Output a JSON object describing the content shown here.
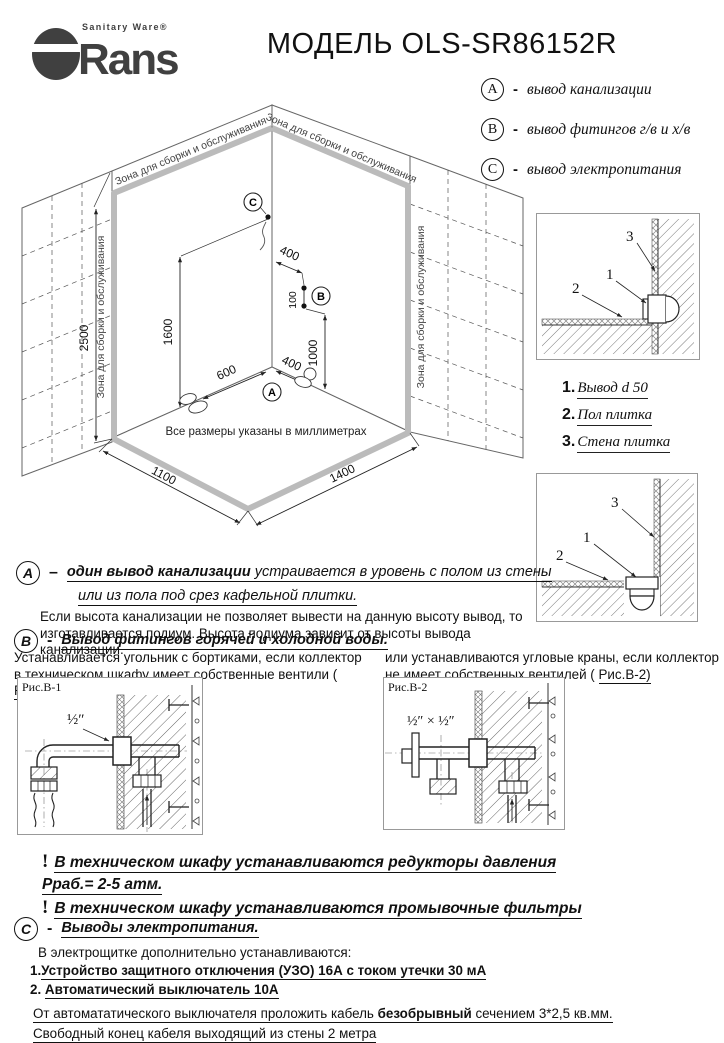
{
  "header": {
    "brand": "Rans",
    "tagline": "Sanitary Ware®",
    "title": "МОДЕЛЬ OLS-SR86152R"
  },
  "legend": {
    "items": [
      {
        "key": "A",
        "dash": "-",
        "label": "вывод канализации"
      },
      {
        "key": "B",
        "dash": "-",
        "label": "вывод фитингов г/в и х/в"
      },
      {
        "key": "C",
        "dash": "-",
        "label": "вывод электропитания"
      }
    ]
  },
  "iso": {
    "zone_text": "Зона для сборки и обслуживания",
    "note": "Все размеры указаны в миллиметрах",
    "dims": {
      "wall_height": "2500",
      "c_height": "1600",
      "b_offset": "400",
      "b_gap": "100",
      "b_height": "1000",
      "floor_left": "600",
      "floor_right": "400",
      "front_left": "1100",
      "front_right": "1400"
    },
    "points": {
      "a": "A",
      "b": "B",
      "c": "C"
    }
  },
  "details": {
    "callout_1": "1",
    "callout_2": "2",
    "callout_3": "3",
    "list": [
      {
        "num": "1.",
        "label": "Вывод d 50"
      },
      {
        "num": "2.",
        "label": "Пол плитка"
      },
      {
        "num": "3.",
        "label": "Стена плитка"
      }
    ]
  },
  "section_a": {
    "key": "A",
    "dash": "–",
    "head_bold": "один вывод канализации",
    "head_rest": " устраивается в уровень с полом из стены",
    "head_line2": "или из пола под срез кафельной плитки.",
    "body_line1": "Если высота канализации не позволяет вывести на данную высоту вывод, то",
    "body_line2": "изготавливается подиум. Высота подиума зависит от высоты вывода канализации."
  },
  "section_b": {
    "key": "B",
    "dash": "-",
    "head": "Вывод фитингов горячей и холодной воды.",
    "left_line1": "Устанавливается угольник с бортиками,  если коллектор",
    "left_line2": "в техническом шкафу имеет собственные вентили ( ",
    "left_ref": "Рис.В-1)",
    "right_line1": "или  устанавливаются угловые краны, если коллектор",
    "right_line2": "не имеет собственных вентилей ( ",
    "right_ref": "Рис.В-2)",
    "fig1": {
      "label": "Рис.В-1",
      "size": "½″"
    },
    "fig2": {
      "label": "Рис.В-2",
      "size": "½″ × ½″"
    }
  },
  "warnings": {
    "mark": "!",
    "w1_line1": "В техническом шкафу устанавливаются редукторы давления",
    "w1_line2": "Рраб.= 2-5 атм.",
    "w2": "В техническом шкафу устанавливаются промывочные фильтры"
  },
  "section_c": {
    "key": "C",
    "dash": "-",
    "head": "Выводы электропитания.",
    "intro": "В электрощитке дополнительно устанавливаются:",
    "item1_num": "1.",
    "item1": "Устройство защитного отключения (УЗО)  16А с током  утечки 30 мА",
    "item2_num": "2.",
    "item2": "Автоматический выключатель 10А",
    "note1_pre": "От автомататического выключателя проложить кабель ",
    "note1_bold": "безобрывный",
    "note1_post": " сечением 3*2,5 кв.мм.",
    "note2": "Свободный конец кабеля выходящий из стены 2 метра"
  }
}
